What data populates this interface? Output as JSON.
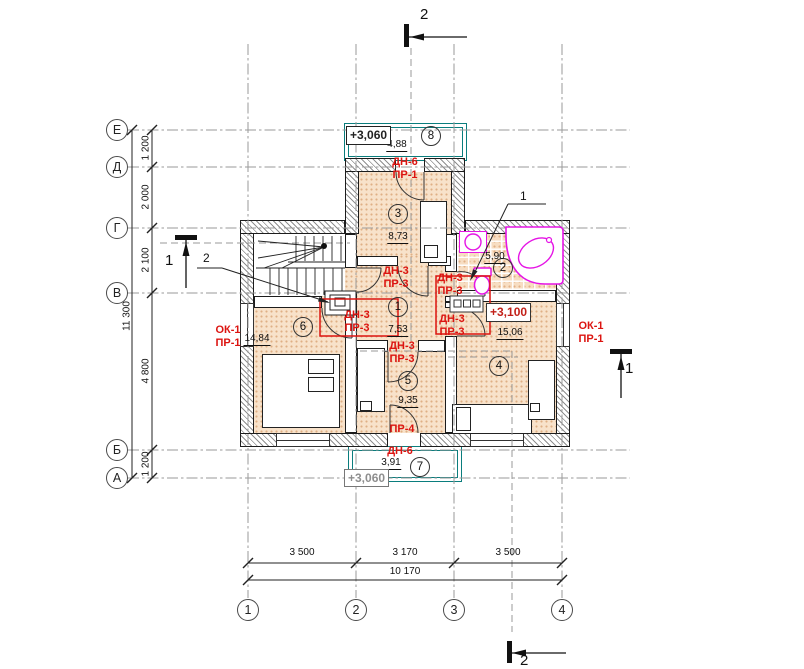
{
  "axes": {
    "rows": [
      "Е",
      "Д",
      "Г",
      "В",
      "Б",
      "А"
    ],
    "cols": [
      "1",
      "2",
      "3",
      "4"
    ]
  },
  "dims": {
    "left": [
      "1 200",
      "2 000",
      "2 100",
      "4 800",
      "1 200"
    ],
    "left_total": "11 300",
    "bottom": [
      "3 500",
      "3 170",
      "3 500"
    ],
    "bottom_total": "10 170"
  },
  "rooms": [
    {
      "num": "1",
      "area": "7,53"
    },
    {
      "num": "2",
      "area": "5,90"
    },
    {
      "num": "3",
      "area": "8,73"
    },
    {
      "num": "4",
      "area": "15,06"
    },
    {
      "num": "5",
      "area": "9,35"
    },
    {
      "num": "6",
      "area": "14,84"
    },
    {
      "num": "7",
      "area": "3,91"
    },
    {
      "num": "8",
      "area": "4,88"
    }
  ],
  "marks": {
    "door_balcony_top": [
      "ДН-6",
      "ПР-1"
    ],
    "door_room3": [
      "ДН-3",
      "ПР-3"
    ],
    "door_bath": [
      "ДН-3",
      "ПР-3"
    ],
    "door_room6": [
      "ДН-3",
      "ПР-3"
    ],
    "door_room4": [
      "ДН-3",
      "ПР-3"
    ],
    "door_room5": [
      "ДН-3",
      "ПР-3"
    ],
    "window_left": [
      "ОК-1",
      "ПР-1"
    ],
    "window_right": [
      "ОК-1",
      "ПР-1"
    ],
    "opening_bottom": "ПР-4",
    "door_balcony_bottom": "ДН-6"
  },
  "elevations": {
    "balcony_top": "+3,060",
    "room4": "+3,100",
    "balcony_bottom": "+3,060"
  },
  "sections": {
    "s1": "1",
    "s2": "2"
  },
  "callouts": {
    "c1": "1",
    "c2": "2"
  },
  "colors": {
    "label_red": "#dc1410",
    "balcony_teal": "#0a7d7d",
    "fixture_magenta": "#e514e5",
    "floor_peach": "#f8e2ca"
  }
}
